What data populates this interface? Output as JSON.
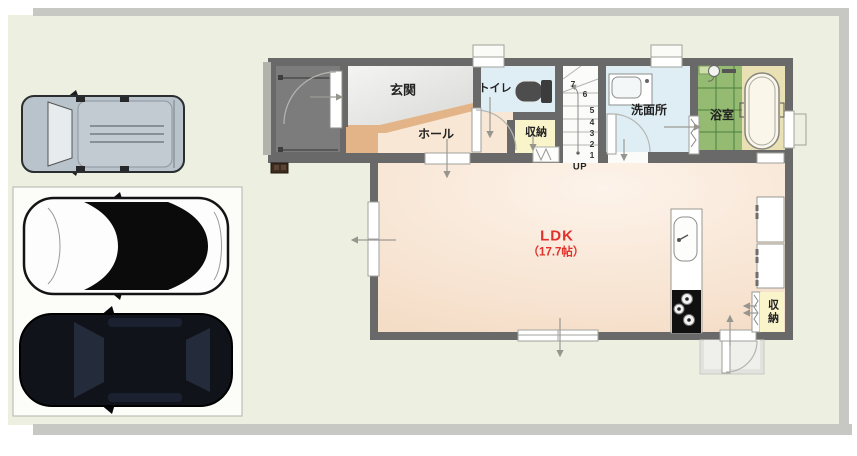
{
  "floorplan": {
    "rooms": {
      "entrance": "玄関",
      "toilet": "トイレ",
      "hall": "ホール",
      "hall_storage": "収納",
      "washroom": "洗面所",
      "bathroom": "浴室",
      "ldk_name": "LDK",
      "ldk_size": "（17.7帖）",
      "kitchen_storage": "収納"
    },
    "stairs": {
      "up": "UP",
      "steps": [
        "1",
        "2",
        "3",
        "4",
        "5",
        "6",
        "7"
      ]
    }
  },
  "colors": {
    "wall": "#696969",
    "site": "#edf0e1",
    "band": "#c7c8c4",
    "porch": "#7c7c7c",
    "porch_step": "#b3b3ad",
    "entrance_floor_light": "#f4f4f2",
    "entrance_floor_dark": "#dcdcda",
    "hall_floor": "#f8e7d4",
    "ldk_floor_light": "#fdf3ea",
    "ldk_floor_dark": "#f4dcc5",
    "wet_floor": "#dfeef4",
    "storage_floor": "#faf4cb",
    "bath_tile": "#94bb71",
    "bath_grid": "#4b7f3e",
    "tub_area": "#e9e1b4",
    "step_wood": "#e2b488",
    "stairs_floor": "#fbfbfa",
    "parking": "#fcfcf9",
    "accent_text": "#e0312a"
  }
}
